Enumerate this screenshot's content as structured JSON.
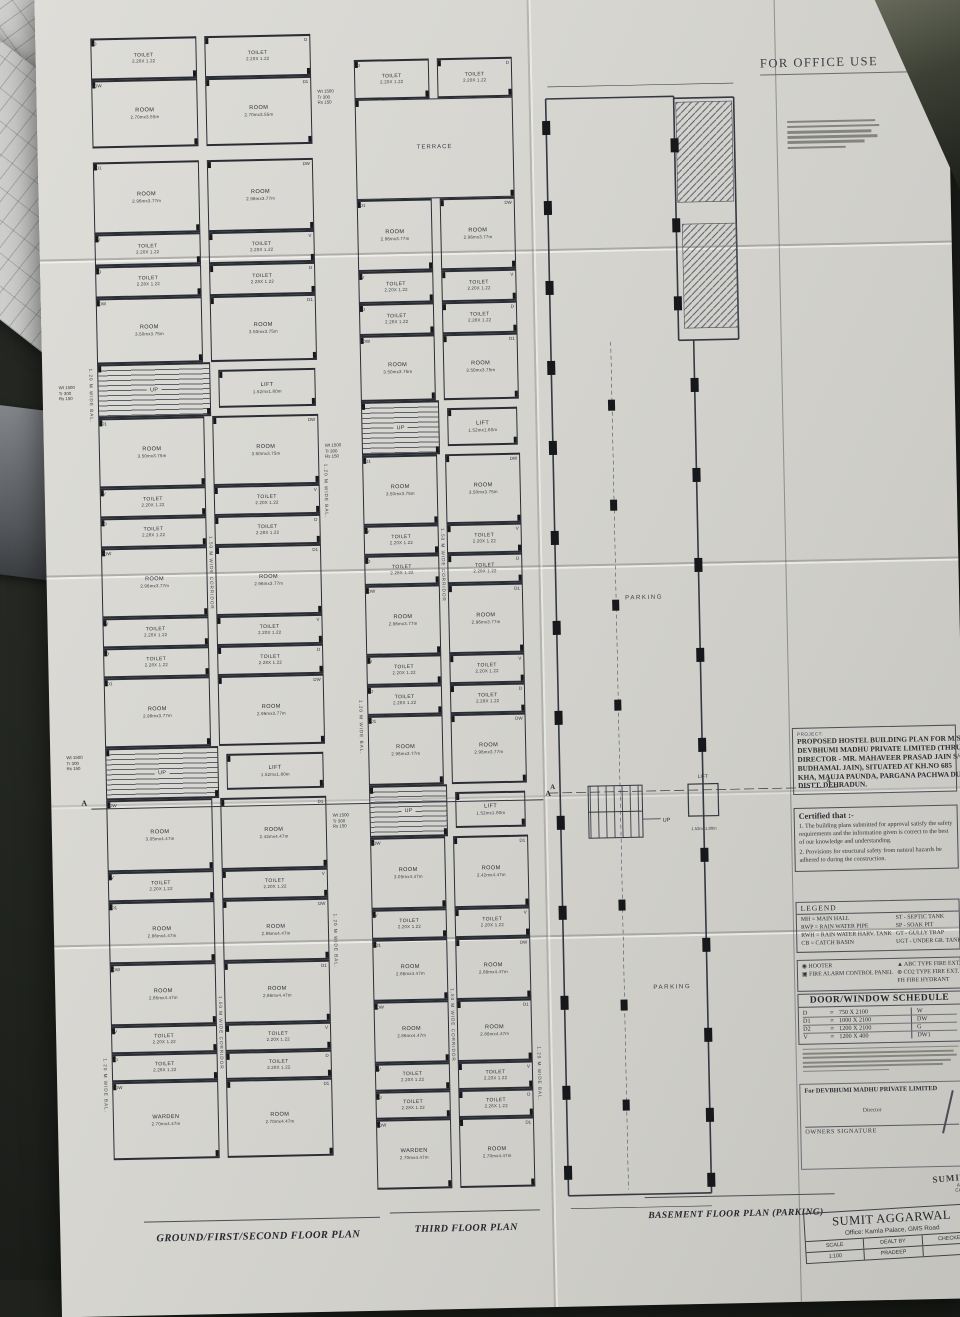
{
  "palette": {
    "desk": "#20231e",
    "paper": "#d7d6d1",
    "ink": "#2e3138",
    "ink_heavy": "#17181c",
    "handwriting_blue": "#3d55a8"
  },
  "header": {
    "for_office_use": "FOR OFFICE USE"
  },
  "project_block": {
    "label": "PROJECT:",
    "lines": [
      "PROPOSED HOSTEL BUILDING PLAN FOR M/S",
      "DEVBHUMI MADHU PRIVATE LIMITED (THRU",
      "DIRECTOR - MR. MAHAVEER PRASAD JAIN S/O",
      "BUDHAMAL JAIN), SITUATED AT KH.NO 685",
      "KHA, MAUJA PAUNDA, PARGANA PACHWA DUN,",
      "DISTT. DEHRADUN."
    ]
  },
  "certificate": {
    "title": "Certified that :-",
    "items": [
      "1. The building plans submitted for approval satisfy the safety requirements and the information given is correct to the best of our knowledge and understanding.",
      "2. Provisions for structural safety from natural hazards be adhered to during the construction."
    ]
  },
  "legend": {
    "title": "LEGEND",
    "left": [
      "MH = MAIN HALL",
      "RWP = RAIN WATER PIPE",
      "RWH = RAIN WATER HARV. TANK",
      "CB = CATCH BASIN"
    ],
    "right": [
      "ST - SEPTIC TANK",
      "SP - SOAK PIT",
      "GT - GULLY TRAP",
      "UGT - UNDER GR. TANK"
    ]
  },
  "fire_legend": {
    "left": [
      "◉ HOOTER",
      "▣ FIRE ALARM CONTROL PANEL"
    ],
    "right": [
      "▲ ABC TYPE FIRE EXT.",
      "⊛ CO2 TYPE FIRE EXT.",
      "FH  FIRE HYDRANT"
    ]
  },
  "door_window_schedule": {
    "title": "DOOR/WINDOW SCHEDULE",
    "equals": "=",
    "rows": [
      {
        "code": "D",
        "size": "750 X 2100",
        "right": "W"
      },
      {
        "code": "D1",
        "size": "1000 X 2100",
        "right": "DW"
      },
      {
        "code": "D2",
        "size": "1200 X 2100",
        "right": "G"
      },
      {
        "code": "V",
        "size": "1200 X 400",
        "right": "DW1"
      }
    ]
  },
  "signature_block": {
    "company": "For DEVBHUMI MADHU PRIVATE LIMITED",
    "role": "Director",
    "caption": "OWNERS SIGNATURE"
  },
  "stamp": {
    "lines": [
      "SUMIT",
      "Arch.",
      "CADA"
    ]
  },
  "title_block": {
    "firm": "SUMIT AGGARWAL",
    "office": "Office: Kamla Palace, GMS Road",
    "cols": [
      "SCALE",
      "DEALT BY",
      "CHECKED"
    ],
    "scale": "1:100",
    "dealt_by": "PRADEEP",
    "checked": ""
  },
  "plan_titles": {
    "ground": "GROUND/FIRST/SECOND FLOOR PLAN",
    "third": "THIRD FLOOR PLAN",
    "basement": "BASEMENT FLOOR PLAN (PARKING)"
  },
  "annotations": {
    "corridor": "1.50 M WIDE CORRIDOR",
    "balcony": "1.20 M WIDE BAL.",
    "stair_note": "Wt 1500\nTr 300\nRs 150",
    "up": "UP",
    "lift": "LIFT",
    "lift_dim": "1.52mx1.80m",
    "parking": "PARKING",
    "section": "A"
  },
  "plans": {
    "ground": {
      "bands": [
        {
          "type": "toilets",
          "h": 42,
          "l": "TOILET",
          "ld": "2.20X 1.22",
          "r": "TOILET",
          "rd": "2.20X 1.22",
          "lt": "D",
          "rt": "D"
        },
        {
          "type": "rooms",
          "h": 68,
          "l": "ROOM",
          "ld": "2.70mx3.55m",
          "r": "ROOM",
          "rd": "2.70mx3.55m",
          "lt": "DW",
          "rt": "D1"
        },
        {
          "type": "gap",
          "h": 14
        },
        {
          "type": "rooms",
          "h": 72,
          "l": "ROOM",
          "ld": "2.96mx3.77m",
          "r": "ROOM",
          "rd": "2.96mx3.77m",
          "lt": "D1",
          "rt": "DW"
        },
        {
          "type": "toilets",
          "h": 32,
          "l": "TOILET",
          "ld": "2.20X 1.22",
          "r": "TOILET",
          "rd": "2.20X 1.22",
          "lt": "V",
          "rt": "V"
        },
        {
          "type": "toilets",
          "h": 32,
          "l": "TOILET",
          "ld": "2.28X 1.22",
          "r": "TOILET",
          "rd": "2.28X 1.22",
          "lt": "D",
          "rt": "D"
        },
        {
          "type": "rooms",
          "h": 66,
          "l": "ROOM",
          "ld": "3.50mx3.75m",
          "r": "ROOM",
          "rd": "3.50mx3.75m",
          "lt": "DW",
          "rt": "D1"
        },
        {
          "type": "stair",
          "h": 54,
          "l": "UP",
          "r": "LIFT",
          "rd": "1.52mx1.80m"
        },
        {
          "type": "rooms",
          "h": 70,
          "l": "ROOM",
          "ld": "3.50mx3.75m",
          "r": "ROOM",
          "rd": "3.50mx3.75m",
          "lt": "D1",
          "rt": "DW"
        },
        {
          "type": "toilets",
          "h": 30,
          "l": "TOILET",
          "ld": "2.20X 1.22",
          "r": "TOILET",
          "rd": "2.20X 1.22",
          "lt": "V",
          "rt": "V"
        },
        {
          "type": "toilets",
          "h": 30,
          "l": "TOILET",
          "ld": "2.28X 1.22",
          "r": "TOILET",
          "rd": "2.28X 1.22",
          "lt": "D",
          "rt": "D"
        },
        {
          "type": "rooms",
          "h": 70,
          "l": "ROOM",
          "ld": "2.96mx3.77m",
          "r": "ROOM",
          "rd": "2.96mx3.77m",
          "lt": "DW",
          "rt": "D1"
        },
        {
          "type": "toilets",
          "h": 30,
          "l": "TOILET",
          "ld": "2.20X 1.22",
          "r": "TOILET",
          "rd": "2.20X 1.22",
          "lt": "V",
          "rt": "V"
        },
        {
          "type": "toilets",
          "h": 30,
          "l": "TOILET",
          "ld": "2.28X 1.22",
          "r": "TOILET",
          "rd": "2.28X 1.22",
          "lt": "D",
          "rt": "D"
        },
        {
          "type": "rooms",
          "h": 70,
          "l": "ROOM",
          "ld": "2.96mx3.77m",
          "r": "ROOM",
          "rd": "2.96mx3.77m",
          "lt": "D1",
          "rt": "DW"
        },
        {
          "type": "stair",
          "h": 52,
          "l": "UP",
          "r": "LIFT",
          "rd": "1.52mx1.80m"
        },
        {
          "type": "rooms",
          "h": 72,
          "l": "ROOM",
          "ld": "3.05mx4.47m",
          "r": "ROOM",
          "rd": "2.42mx4.47m",
          "lt": "DW",
          "rt": "D1"
        },
        {
          "type": "toilets",
          "h": 30,
          "l": "TOILET",
          "ld": "2.20X 1.22",
          "r": "TOILET",
          "rd": "2.20X 1.22",
          "lt": "V",
          "rt": "V"
        },
        {
          "type": "rooms",
          "h": 62,
          "l": "ROOM",
          "ld": "2.86mx4.47m",
          "r": "ROOM",
          "rd": "2.86mx4.47m",
          "lt": "D1",
          "rt": "DW"
        },
        {
          "type": "rooms",
          "h": 62,
          "l": "ROOM",
          "ld": "2.86mx4.47m",
          "r": "ROOM",
          "rd": "2.86mx4.47m",
          "lt": "DW",
          "rt": "D1"
        },
        {
          "type": "toilets",
          "h": 28,
          "l": "TOILET",
          "ld": "2.20X 1.22",
          "r": "TOILET",
          "rd": "2.20X 1.22",
          "lt": "V",
          "rt": "V"
        },
        {
          "type": "toilets",
          "h": 28,
          "l": "TOILET",
          "ld": "2.28X 1.22",
          "r": "TOILET",
          "rd": "2.28X 1.22",
          "lt": "D",
          "rt": "D"
        },
        {
          "type": "rooms",
          "h": 78,
          "l": "WARDEN",
          "ld": "2.70mx4.47m",
          "r": "ROOM",
          "rd": "2.70mx4.47m",
          "lt": "DW",
          "rt": "D1"
        }
      ]
    },
    "third": {
      "bands": [
        {
          "type": "toilets",
          "h": 40,
          "l": "TOILET",
          "ld": "2.20X 1.22",
          "r": "TOILET",
          "rd": "2.20X 1.22",
          "lt": "D",
          "rt": "D"
        },
        {
          "type": "wide",
          "h": 100,
          "l": "TERRACE"
        },
        {
          "type": "rooms",
          "h": 72,
          "l": "ROOM",
          "ld": "2.96mx3.77m",
          "r": "ROOM",
          "rd": "2.96mx3.77m",
          "lt": "D1",
          "rt": "DW"
        },
        {
          "type": "toilets",
          "h": 32,
          "l": "TOILET",
          "ld": "2.20X 1.22",
          "r": "TOILET",
          "rd": "2.20X 1.22",
          "lt": "V",
          "rt": "V"
        },
        {
          "type": "toilets",
          "h": 32,
          "l": "TOILET",
          "ld": "2.28X 1.22",
          "r": "TOILET",
          "rd": "2.28X 1.22",
          "lt": "D",
          "rt": "D"
        },
        {
          "type": "rooms",
          "h": 66,
          "l": "ROOM",
          "ld": "3.50mx3.75m",
          "r": "ROOM",
          "rd": "3.50mx3.75m",
          "lt": "DW",
          "rt": "D1"
        },
        {
          "type": "stair",
          "h": 54,
          "l": "UP",
          "r": "LIFT",
          "rd": "1.52mx1.80m"
        },
        {
          "type": "rooms",
          "h": 70,
          "l": "ROOM",
          "ld": "3.50mx3.75m",
          "r": "ROOM",
          "rd": "3.50mx3.75m",
          "lt": "D1",
          "rt": "DW"
        },
        {
          "type": "toilets",
          "h": 30,
          "l": "TOILET",
          "ld": "2.20X 1.22",
          "r": "TOILET",
          "rd": "2.20X 1.22",
          "lt": "V",
          "rt": "V"
        },
        {
          "type": "toilets",
          "h": 30,
          "l": "TOILET",
          "ld": "2.28X 1.22",
          "r": "TOILET",
          "rd": "2.28X 1.22",
          "lt": "D",
          "rt": "D"
        },
        {
          "type": "rooms",
          "h": 70,
          "l": "ROOM",
          "ld": "2.96mx3.77m",
          "r": "ROOM",
          "rd": "2.96mx3.77m",
          "lt": "DW",
          "rt": "D1"
        },
        {
          "type": "toilets",
          "h": 30,
          "l": "TOILET",
          "ld": "2.20X 1.22",
          "r": "TOILET",
          "rd": "2.20X 1.22",
          "lt": "V",
          "rt": "V"
        },
        {
          "type": "toilets",
          "h": 30,
          "l": "TOILET",
          "ld": "2.28X 1.22",
          "r": "TOILET",
          "rd": "2.28X 1.22",
          "lt": "D",
          "rt": "D"
        },
        {
          "type": "rooms",
          "h": 70,
          "l": "ROOM",
          "ld": "2.96mx3.77m",
          "r": "ROOM",
          "rd": "2.96mx3.77m",
          "lt": "D1",
          "rt": "DW"
        },
        {
          "type": "stair",
          "h": 52,
          "l": "UP",
          "r": "LIFT",
          "rd": "1.52mx1.80m"
        },
        {
          "type": "rooms",
          "h": 72,
          "l": "ROOM",
          "ld": "3.05mx4.47m",
          "r": "ROOM",
          "rd": "2.42mx4.47m",
          "lt": "DW",
          "rt": "D1"
        },
        {
          "type": "toilets",
          "h": 30,
          "l": "TOILET",
          "ld": "2.20X 1.22",
          "r": "TOILET",
          "rd": "2.20X 1.22",
          "lt": "V",
          "rt": "V"
        },
        {
          "type": "rooms",
          "h": 62,
          "l": "ROOM",
          "ld": "2.86mx4.47m",
          "r": "ROOM",
          "rd": "2.86mx4.47m",
          "lt": "D1",
          "rt": "DW"
        },
        {
          "type": "rooms",
          "h": 62,
          "l": "ROOM",
          "ld": "2.86mx4.47m",
          "r": "ROOM",
          "rd": "2.86mx4.47m",
          "lt": "DW",
          "rt": "D1"
        },
        {
          "type": "toilets",
          "h": 28,
          "l": "TOILET",
          "ld": "2.20X 1.22",
          "r": "TOILET",
          "rd": "2.20X 1.22",
          "lt": "V",
          "rt": "V"
        },
        {
          "type": "toilets",
          "h": 28,
          "l": "TOILET",
          "ld": "2.28X 1.22",
          "r": "TOILET",
          "rd": "2.28X 1.22",
          "lt": "D",
          "rt": "D"
        },
        {
          "type": "rooms",
          "h": 70,
          "l": "WARDEN",
          "ld": "2.70mx4.47m",
          "r": "ROOM",
          "rd": "2.70mx4.47m",
          "lt": "DW",
          "rt": "D1"
        }
      ]
    }
  }
}
